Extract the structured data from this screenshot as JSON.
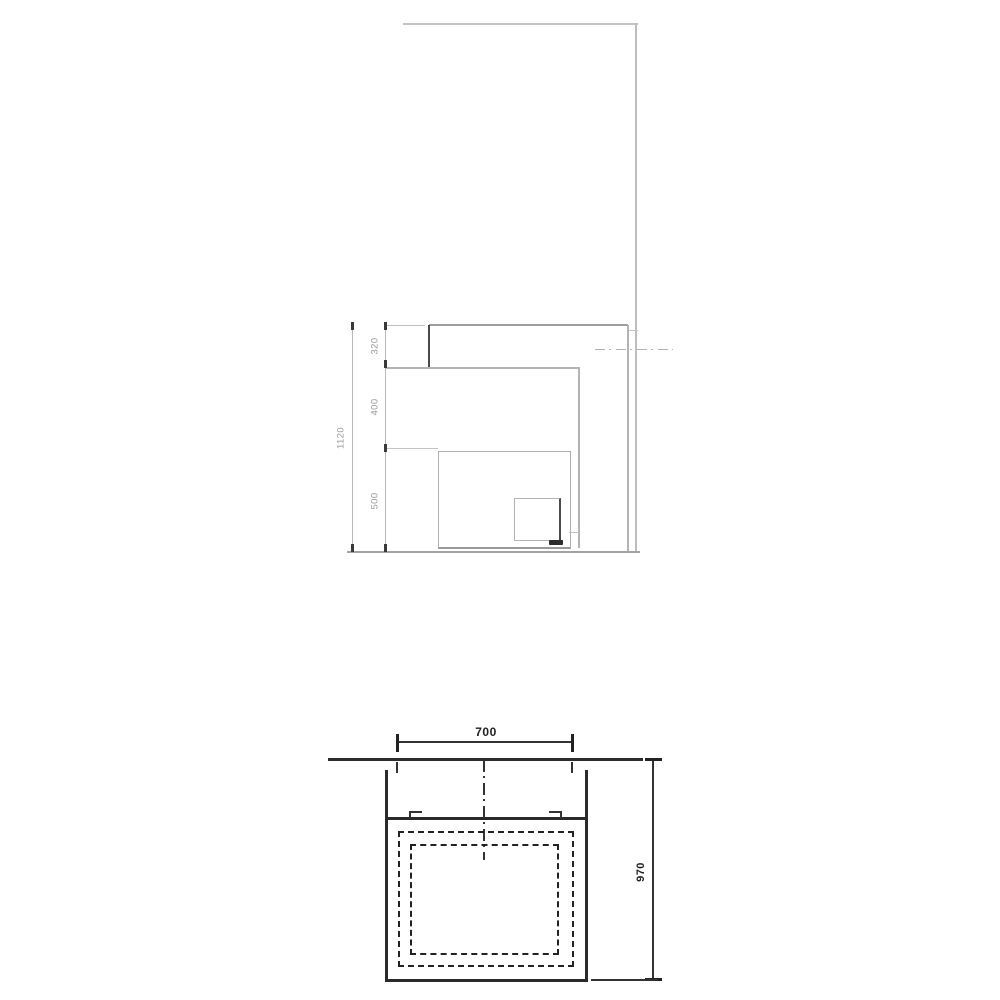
{
  "elevation": {
    "total_height_label": "1120",
    "segment_labels": [
      "320",
      "400",
      "500"
    ]
  },
  "plan": {
    "width_label": "700",
    "depth_label": "970"
  },
  "colors": {
    "background": "#ffffff",
    "elevation_line": "#b3b3b3",
    "elevation_accent": "#4a4a4a",
    "plan_line": "#2a2a2a",
    "dim_text_elevation": "#9a9a9a",
    "dim_text_plan": "#1f1f1f"
  }
}
